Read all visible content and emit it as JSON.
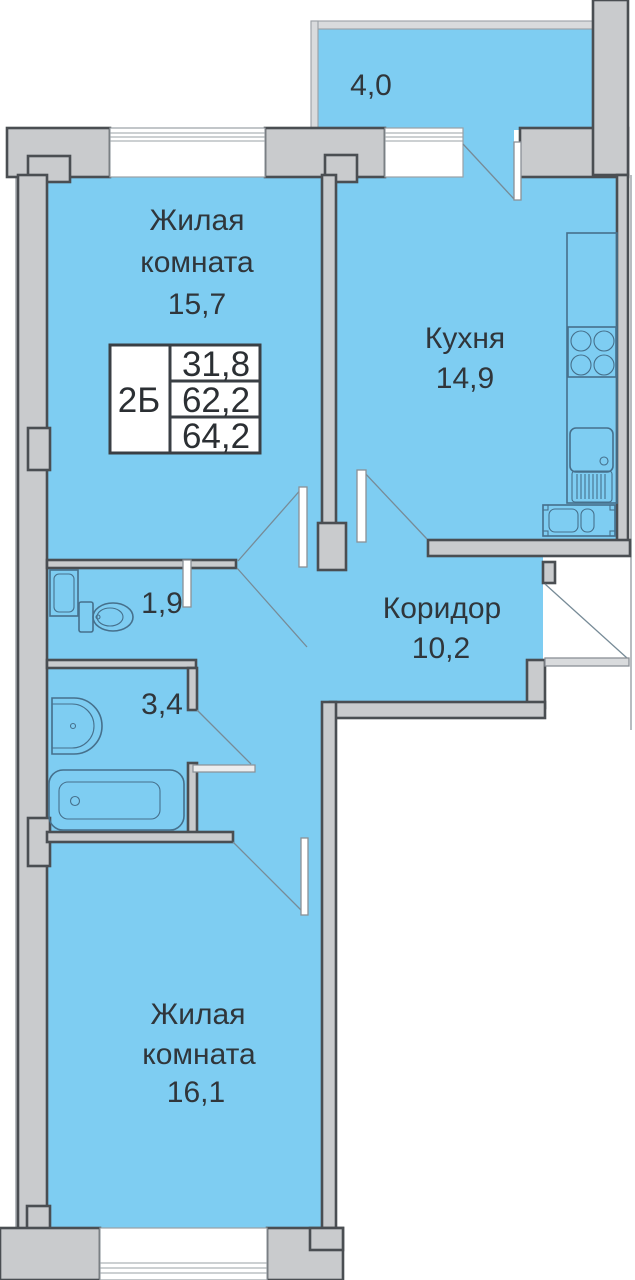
{
  "plan": {
    "unit_label": "2Б",
    "info_table": {
      "living_area": "31,8",
      "apartment_area": "62,2",
      "total_area": "64,2"
    },
    "rooms": [
      {
        "id": "living-room-1",
        "name_line1": "Жилая",
        "name_line2": "комната",
        "area": "15,7"
      },
      {
        "id": "kitchen",
        "name_line1": "Кухня",
        "area": "14,9"
      },
      {
        "id": "balcony",
        "area": "4,0"
      },
      {
        "id": "corridor",
        "name_line1": "Коридор",
        "area": "10,2"
      },
      {
        "id": "wc",
        "area": "1,9"
      },
      {
        "id": "bathroom",
        "area": "3,4"
      },
      {
        "id": "living-room-2",
        "name_line1": "Жилая",
        "name_line2": "комната",
        "area": "16,1"
      }
    ],
    "colors": {
      "floor": "#7ECDF2",
      "wall": "#C9CBCD",
      "walledge": "#4A4E52",
      "fixture": "#46708C",
      "swing": "#778B97",
      "text": "#30363B",
      "winline": "#9AA0A5",
      "leafstroke": "#8A9096",
      "rail": "#D9DBDD",
      "tableborder": "#3A3F44"
    }
  }
}
